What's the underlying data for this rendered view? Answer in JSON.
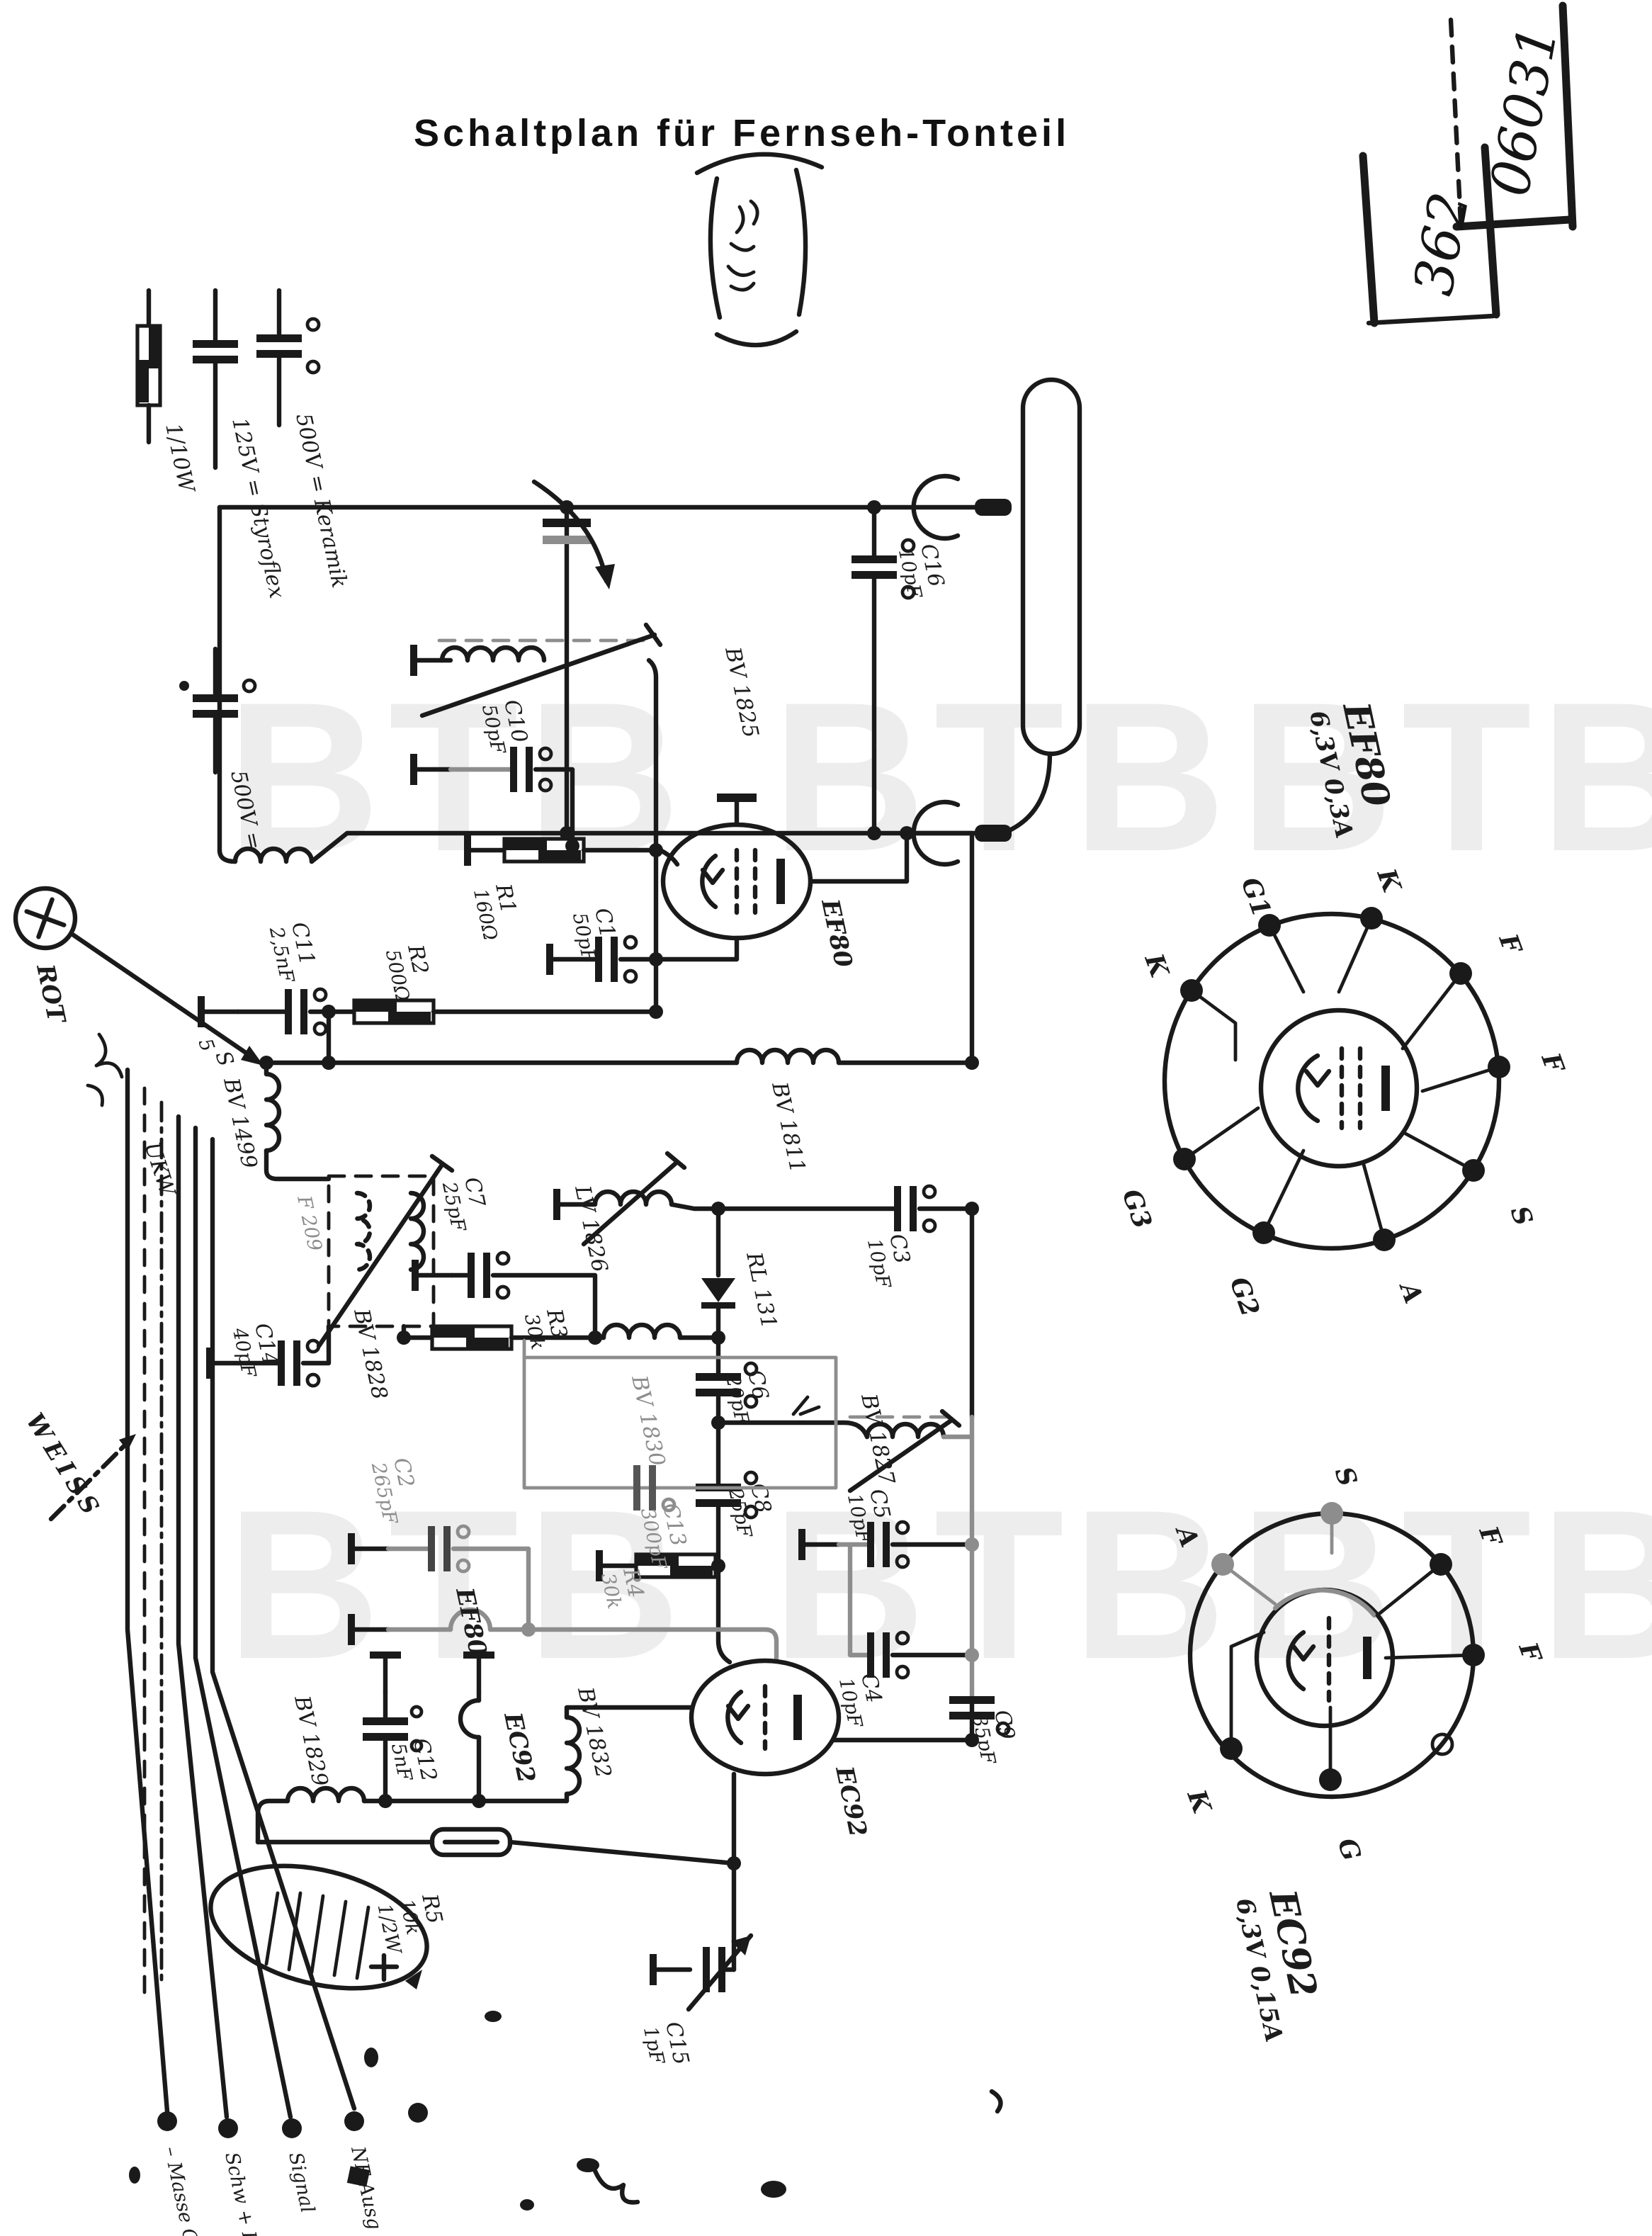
{
  "title": "Schaltplan für Fernseh-Tonteil",
  "stamps": {
    "upper": "06031",
    "lower": "362"
  },
  "watermark": "BTB",
  "legend": {
    "resistor": "1/10W",
    "styroflex": "125V = Styroflex",
    "keramik": "500V = Keramik",
    "cap500": "500V ="
  },
  "wires": {
    "rot": "ROT",
    "weiss": "WEISS",
    "ukw": "UKW"
  },
  "annotations": {
    "s_mark": "S",
    "five_mark": "5"
  },
  "terminals": [
    "– Masse G",
    "Schw + H",
    "Signal",
    "NF Ausg"
  ],
  "tubes": {
    "ef80": "EF80",
    "ec92": "EC92"
  },
  "components": {
    "c1": {
      "name": "C1",
      "value": "50pF"
    },
    "c2": {
      "name": "C2",
      "value": "265pF"
    },
    "c3": {
      "name": "C3",
      "value": "10pF"
    },
    "c4": {
      "name": "C4",
      "value": "10pF"
    },
    "c5": {
      "name": "C5",
      "value": "10pF"
    },
    "c6": {
      "name": "C6",
      "value": "20pF"
    },
    "c7": {
      "name": "C7",
      "value": "25pF"
    },
    "c8": {
      "name": "C8",
      "value": "25pF"
    },
    "c9": {
      "name": "C9",
      "value": "35pF"
    },
    "c10": {
      "name": "C10",
      "value": "50pF"
    },
    "c11": {
      "name": "C11",
      "value": "2,5nF"
    },
    "c12": {
      "name": "C12",
      "value": "5nF"
    },
    "c13": {
      "name": "C13",
      "value": "300pF"
    },
    "c14": {
      "name": "C14",
      "value": "40pF"
    },
    "c15": {
      "name": "C15",
      "value": "1pF"
    },
    "c16": {
      "name": "C16",
      "value": "10pF"
    },
    "r1": {
      "name": "R1",
      "value": "160Ω"
    },
    "r2": {
      "name": "R2",
      "value": "500Ω"
    },
    "r3": {
      "name": "R3",
      "value": "30k"
    },
    "r4": {
      "name": "R4",
      "value": "30k"
    },
    "r5": {
      "name": "R5",
      "value": "10k",
      "value2": "1/2W"
    },
    "rl131": {
      "name": "RL 131"
    },
    "bv1499": {
      "name": "BV 1499"
    },
    "bv1811": {
      "name": "BV 1811"
    },
    "bv1825": {
      "name": "BV 1825"
    },
    "lv1826": {
      "name": "LV 1826"
    },
    "bv1827": {
      "name": "BV 1827"
    },
    "bv1828": {
      "name": "BV 1828"
    },
    "bv1829": {
      "name": "BV 1829"
    },
    "bv1830": {
      "name": "BV 1830"
    },
    "bv1832": {
      "name": "BV 1832"
    },
    "f209": {
      "name": "F 209"
    }
  },
  "sockets": {
    "ef80": {
      "type": "EF80",
      "heater": "6,3V 0,3A",
      "pins": [
        "K",
        "G1",
        "K",
        "F",
        "F",
        "S",
        "A",
        "G2",
        "G3"
      ]
    },
    "ec92": {
      "type": "EC92",
      "heater": "6,3V 0,15A",
      "pins": [
        "S",
        "A",
        "F",
        "F",
        "K",
        "G"
      ]
    }
  }
}
